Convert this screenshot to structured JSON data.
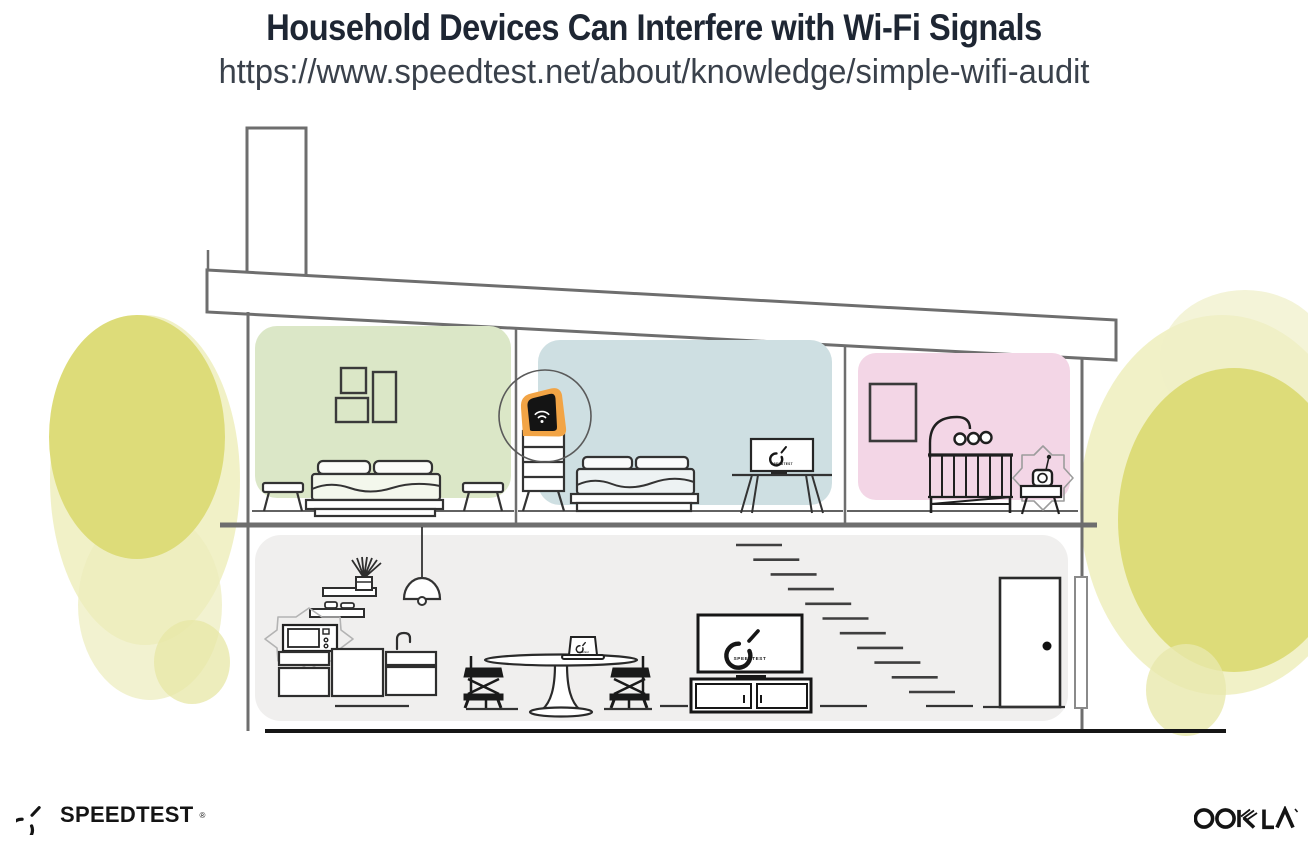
{
  "header": {
    "title": "Household Devices Can Interfere with Wi-Fi Signals",
    "url": "https://www.speedtest.net/about/knowledge/simple-wifi-audit"
  },
  "footer": {
    "speedtest_wordmark": "SPEEDTEST",
    "speedtest_reg": "®",
    "ookla_wordmark": "OOKLA"
  },
  "screens": {
    "bedroom_tv_label": "SPEEDTEST",
    "living_tv_label": "SPEEDTEST",
    "laptop_label": "SPEEDTEST"
  },
  "colors": {
    "title_text": "#1e2633",
    "url_text": "#3a414b",
    "room_green": "#dbe7c7",
    "room_blue": "#cedfe2",
    "room_pink": "#f3d6e6",
    "lower_floor": "#f0efee",
    "router_highlight": "#f2a445",
    "tree_core": "#dddc79",
    "tree_halo": "#eeeebd",
    "ink": "#161616",
    "structure_gray": "#6e6e6e"
  },
  "illustration": {
    "rooms": [
      {
        "name": "bedroom-green",
        "floor": "upper",
        "items": [
          "wall art frames",
          "double bed",
          "two stools"
        ]
      },
      {
        "name": "bedroom-blue",
        "floor": "upper",
        "items": [
          "wi-fi router on shelf (circled highlight)",
          "double bed",
          "tv on table showing Speedtest"
        ]
      },
      {
        "name": "nursery-pink",
        "floor": "upper",
        "items": [
          "wall frame",
          "baby mobile",
          "crib",
          "baby monitor with interference burst"
        ]
      },
      {
        "name": "main-floor",
        "floor": "lower",
        "items": [
          "wall shelves with plant and bowls",
          "pendant lamp",
          "microwave with interference burst",
          "kitchen cabinets and sink",
          "round dining table with laptop showing Speedtest",
          "two dining chairs",
          "tv on media console showing Speedtest",
          "staircase",
          "front door"
        ]
      }
    ],
    "interference_sources": [
      "microwave",
      "baby monitor"
    ],
    "highlighted_device": "wi-fi router"
  }
}
